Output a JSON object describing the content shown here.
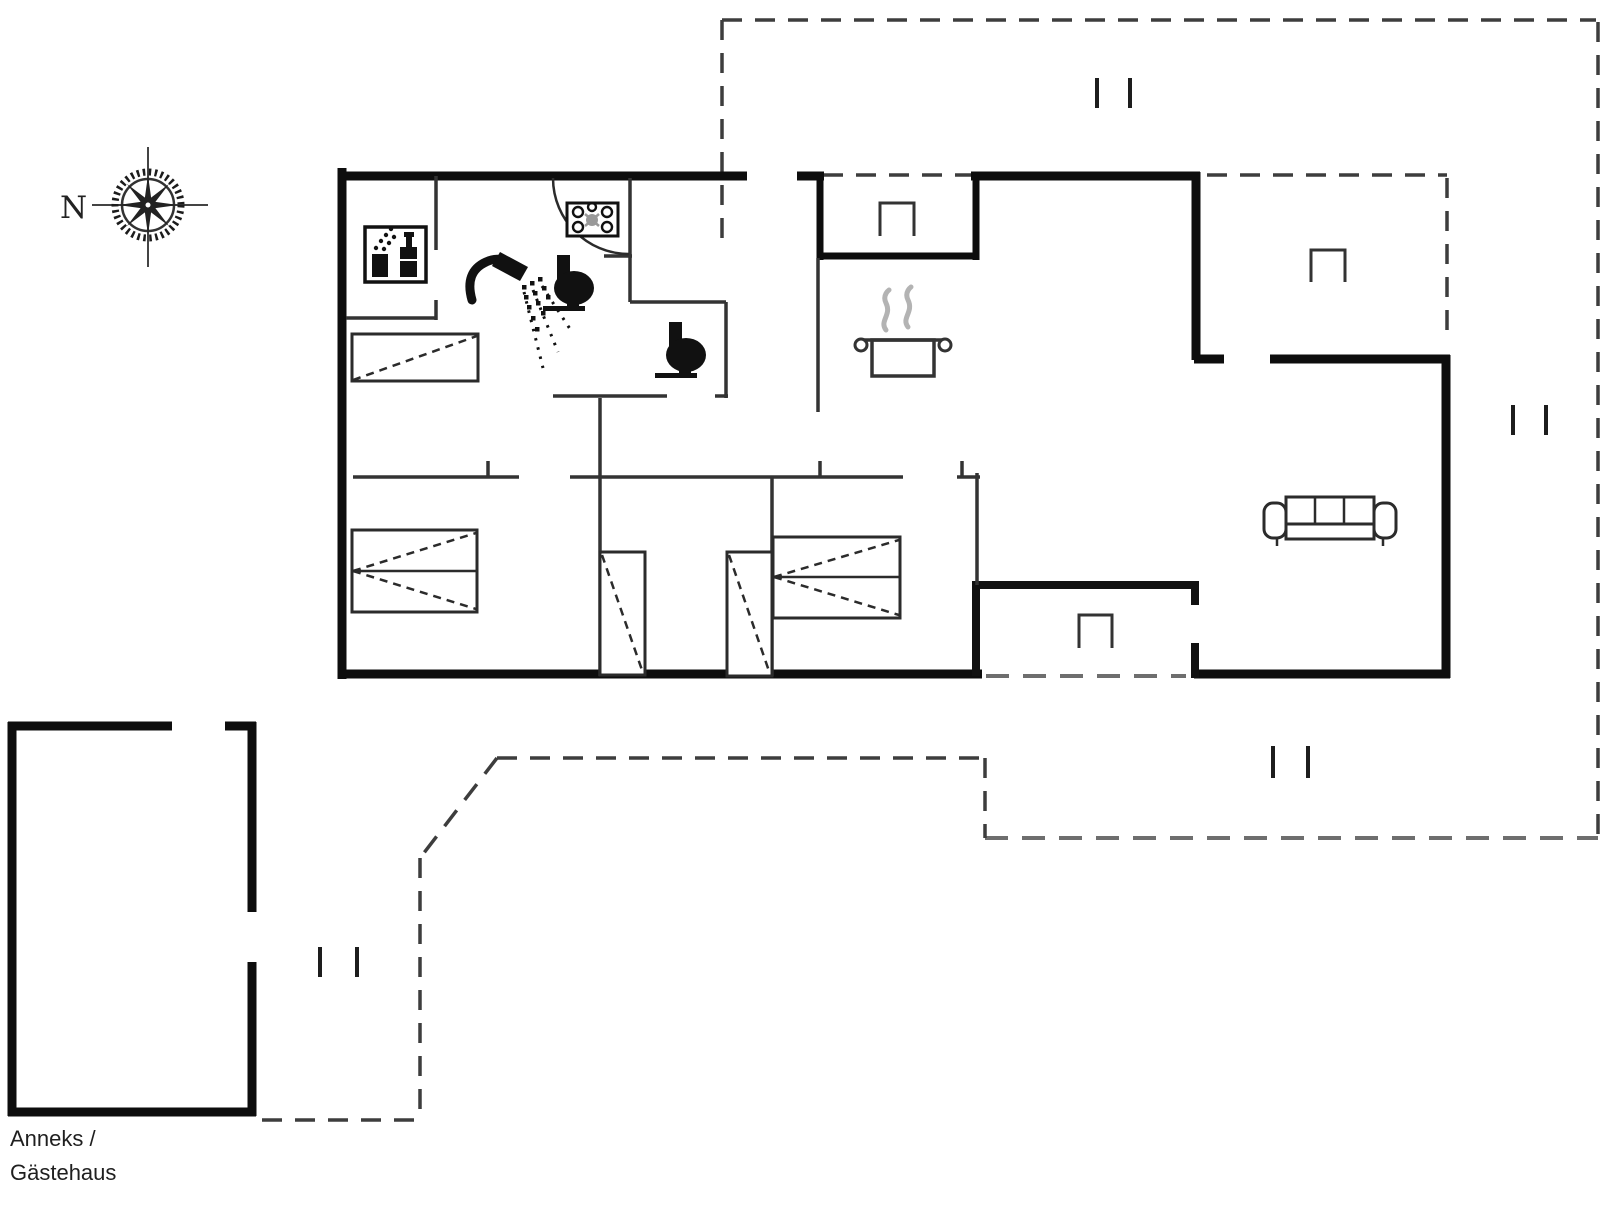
{
  "compass": {
    "label": "N"
  },
  "annex_label": {
    "line1": "Anneks /",
    "line2": "Gästehaus"
  },
  "colors": {
    "background": "#ffffff",
    "exterior_wall": "#0d0d0d",
    "interior_wall": "#333333",
    "terrace_dash": "#3d3d3d",
    "terrace_dash_light": "#6e6e6e",
    "furniture": "#2b2b2b",
    "icon_black": "#111111",
    "steam_gray": "#b3b3b3",
    "hob_center_gray": "#999999"
  },
  "icons": [
    {
      "name": "compass-rose-icon"
    },
    {
      "name": "washing-machine-icon"
    },
    {
      "name": "hob-icon"
    },
    {
      "name": "shower-icon"
    },
    {
      "name": "toilet-icon"
    },
    {
      "name": "toilet-icon"
    },
    {
      "name": "cooking-pot-icon"
    },
    {
      "name": "wardrobe-symbol"
    },
    {
      "name": "double-bed-symbol"
    },
    {
      "name": "single-bed-symbol"
    },
    {
      "name": "single-bed-symbol"
    },
    {
      "name": "double-bed-symbol"
    },
    {
      "name": "sofa-icon"
    },
    {
      "name": "niche-marker"
    },
    {
      "name": "niche-marker"
    },
    {
      "name": "niche-marker"
    }
  ]
}
